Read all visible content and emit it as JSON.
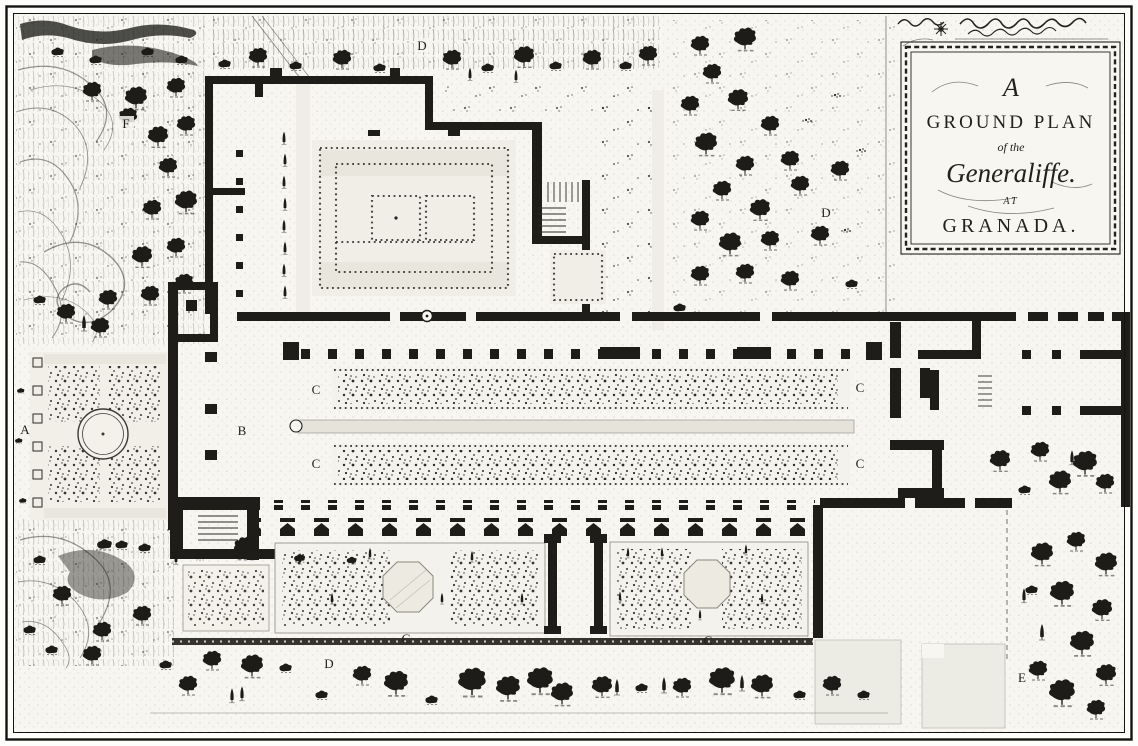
{
  "page": {
    "width": 1138,
    "height": 746
  },
  "colors": {
    "paper": "#f7f6f1",
    "ink": "#1e1d19",
    "pale_garden": "#efede5",
    "water_channel": "#e5e3da"
  },
  "cartouche": {
    "heading_initial": "A",
    "line_ground_plan": "GROUND PLAN",
    "line_of_the": "of the",
    "line_generalife": "Generaliffe.",
    "line_at": "AT",
    "line_granada": "GRANADA."
  },
  "labels": [
    {
      "text": "D"
    },
    {
      "text": "F"
    },
    {
      "text": "D"
    },
    {
      "text": "A"
    },
    {
      "text": "B"
    },
    {
      "text": "C"
    },
    {
      "text": "C"
    },
    {
      "text": "C"
    },
    {
      "text": "C"
    },
    {
      "text": "C"
    },
    {
      "text": "C"
    },
    {
      "text": "D"
    },
    {
      "text": "E"
    }
  ]
}
